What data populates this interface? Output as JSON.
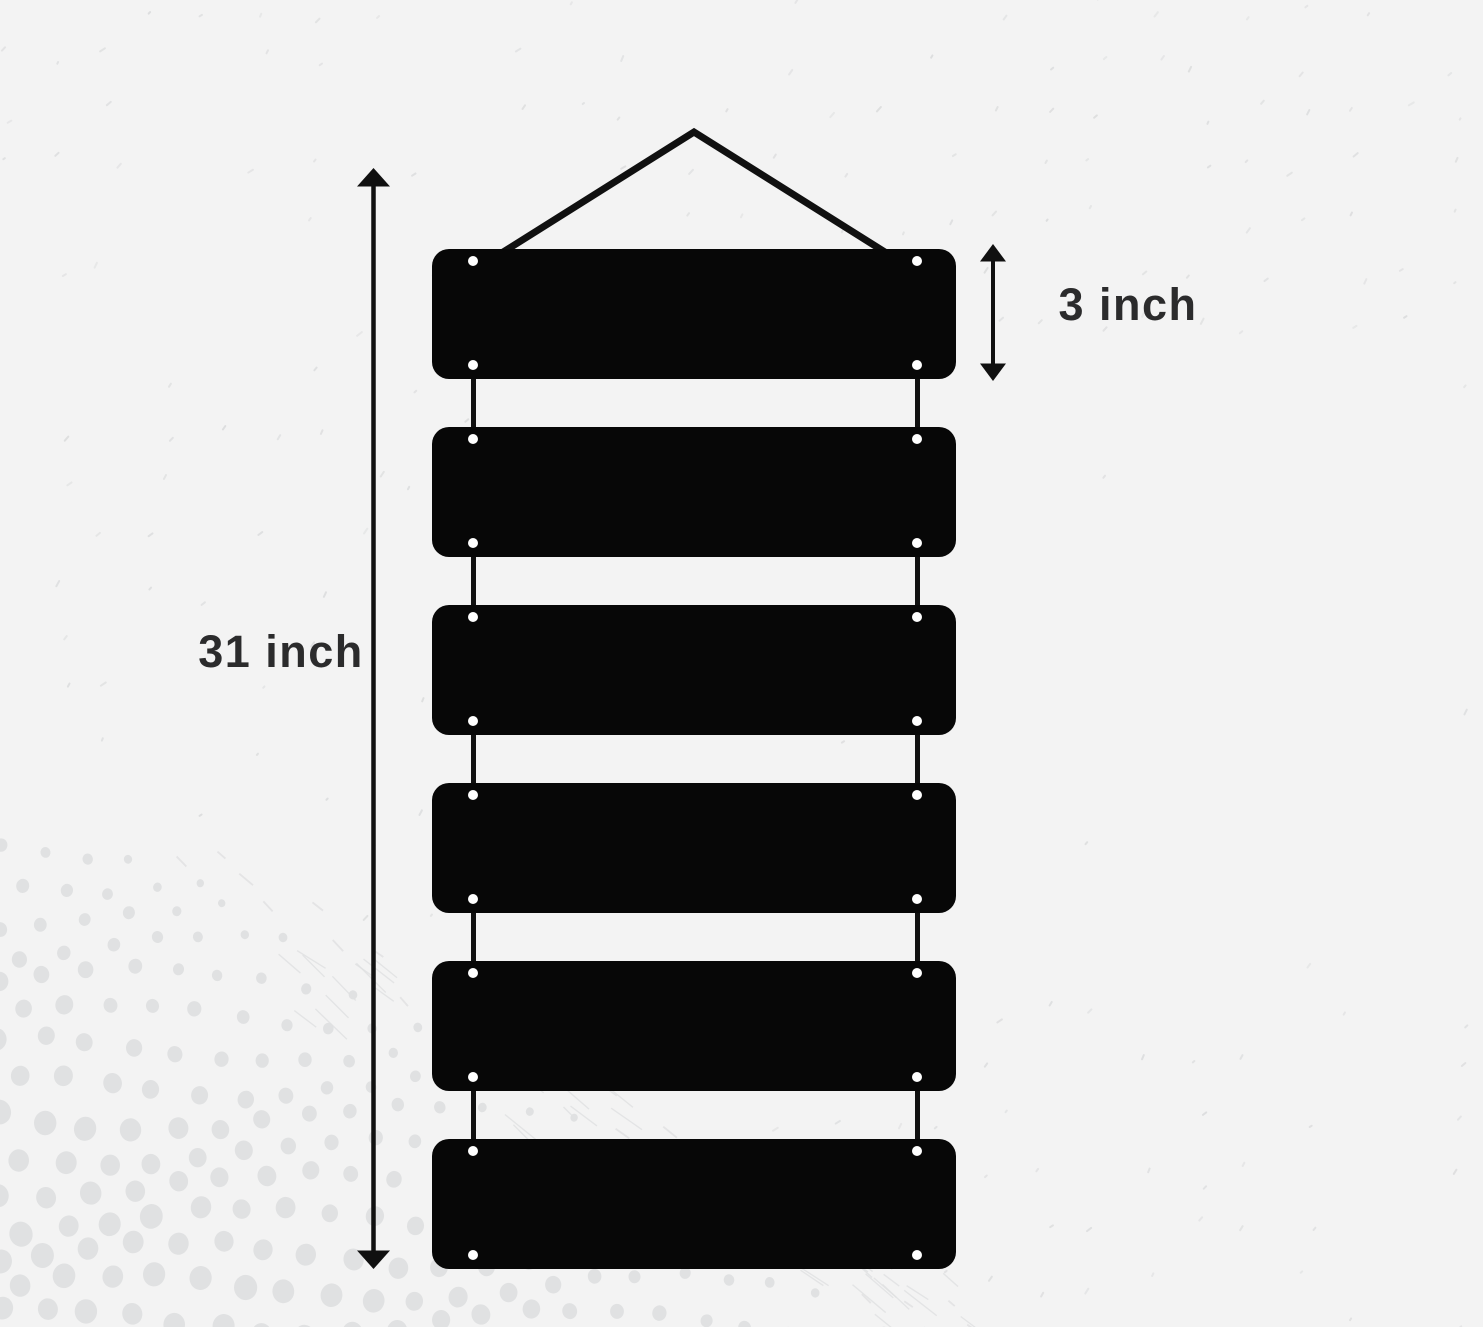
{
  "diagram": {
    "title": "hanging-plank-sign-dimensions",
    "height_label": "31 inch",
    "plank_height_label": "3 inch",
    "plank_count": 6,
    "colors": {
      "background": "#f3f3f3",
      "plank": "#070707",
      "line": "#101010",
      "label": "#2b2b2c",
      "hole": "#ffffff",
      "halftone_dot": "#e0e1e2",
      "tick": "#d9dadb"
    }
  }
}
